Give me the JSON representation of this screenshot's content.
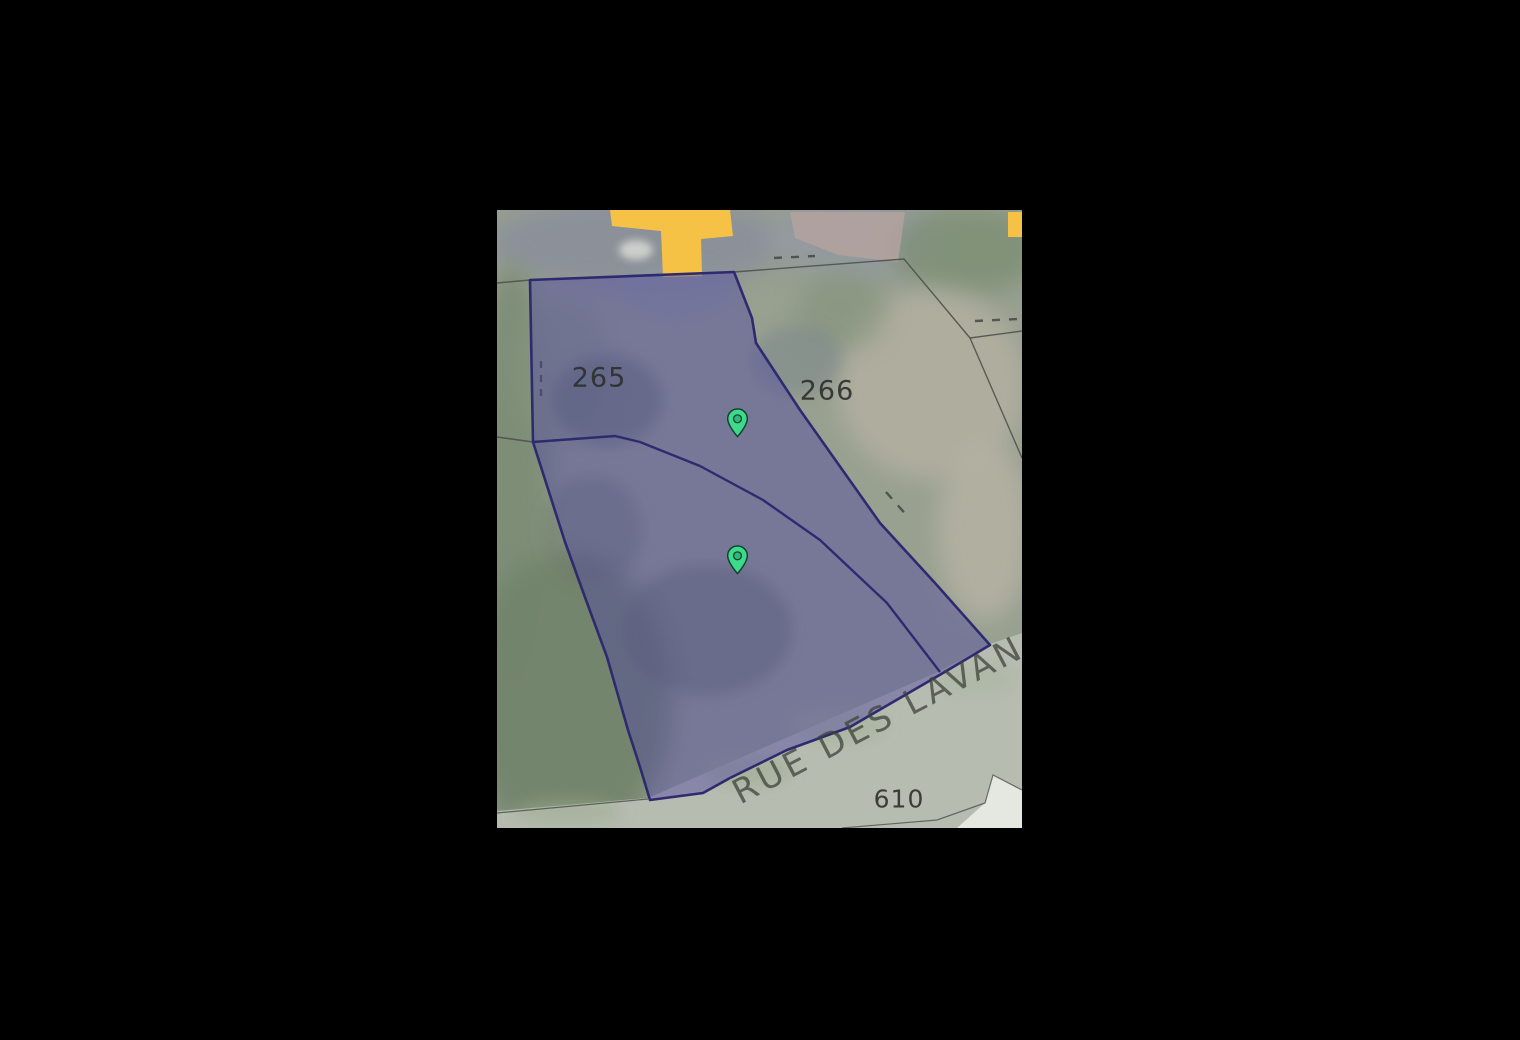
{
  "map": {
    "street_label": "RUE DES LAVAN",
    "parcel_labels": [
      {
        "id": "265",
        "text": "265"
      },
      {
        "id": "266",
        "text": "266"
      },
      {
        "id": "610",
        "text": "610"
      }
    ],
    "pins": [
      {
        "x": 240,
        "y": 227
      },
      {
        "x": 240,
        "y": 364
      }
    ],
    "colors": {
      "parcel_fill": "rgba(80,72,160,0.45)",
      "parcel_stroke": "#2f2a70",
      "boundary_gray": "#4e524b",
      "road_yellow": "#f6c245",
      "road_surface": "#b6bcb0",
      "building_pink": "#b3a29f",
      "roof_white": "#e9ece6",
      "pin_green": "#3fd98c",
      "pin_inner": "#2fb878",
      "pin_outline": "#0d4431",
      "label_color": "#2b2c29",
      "street_label_color": "rgba(62,66,60,0.75)"
    }
  }
}
